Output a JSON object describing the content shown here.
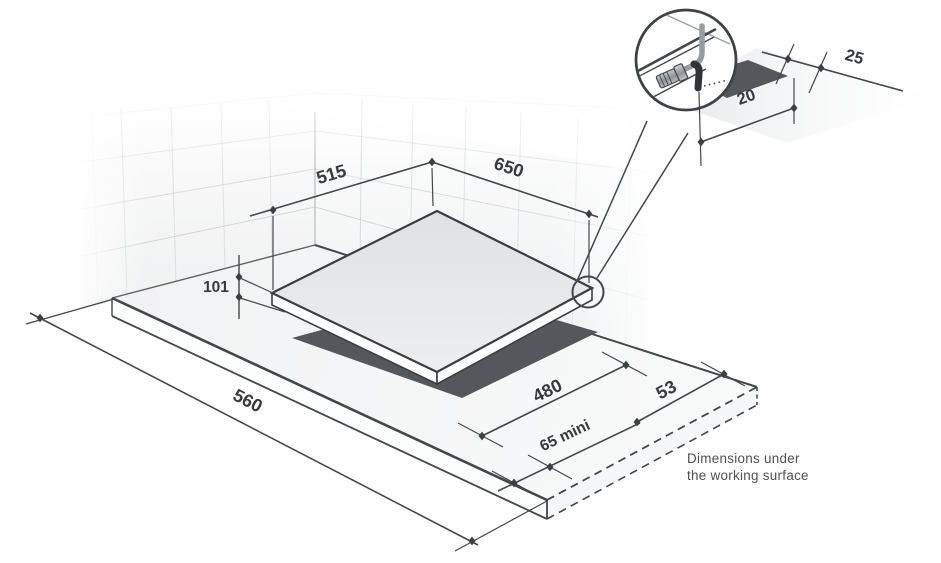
{
  "diagram": {
    "dims": {
      "cooktop_depth": "515",
      "cooktop_width": "650",
      "build_under_height": "101",
      "worktop_front_width": "560",
      "cutout_width": "480",
      "cutout_side_clearance": "53",
      "front_clearance_min": "65 mini",
      "detail_back_clearance": "25",
      "detail_front_clearance": "20"
    },
    "caption": {
      "line1": "Dimensions under",
      "line2": "the working surface"
    },
    "colors": {
      "line": "#43474b",
      "cutout": "#54585c",
      "glass": "#e6e7e9",
      "tile": "#c8cacc"
    }
  }
}
